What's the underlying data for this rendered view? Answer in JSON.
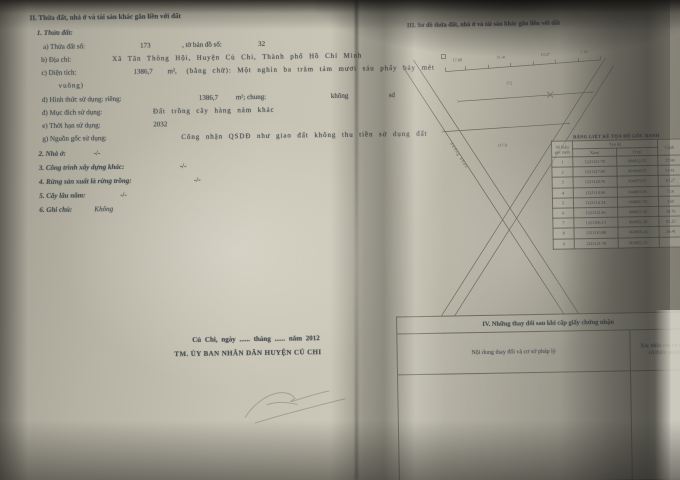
{
  "section_ii": {
    "heading": "II. Thửa đất, nhà ở và tài sản khác gắn liền với đất",
    "parcel": {
      "title": "1. Thửa đất:",
      "a_label": "a) Thửa đất số:",
      "a_value": "173",
      "a_label2": ", tờ bản đồ số:",
      "a_value2": "32",
      "b_label": "b) Địa chỉ:",
      "b_value": "Xã Tân Thông Hội, Huyện Củ Chi, Thành phố Hồ Chí Minh",
      "c_label": "c) Diện tích:",
      "c_value": "1386,7",
      "c_unit": "m²,",
      "c_words": "(bằng chữ): Một nghìn ba trăm tám mươi sáu phẩy bảy mét",
      "c_words_cont": "vuông)",
      "d_label": "d) Hình thức sử dụng: riêng:",
      "d_value": "1386,7",
      "d_mid": "m²; chung:",
      "d_value2": "không",
      "d_suffix": "sd",
      "dd_label": "đ) Mục đích sử dụng:",
      "dd_value": "Đất trồng cây hàng năm khác",
      "e_label": "e) Thời hạn sử dụng:",
      "e_value": "2032",
      "g_label": "g) Nguồn gốc sử dụng:",
      "g_value": "Công nhận QSDĐ như giao đất không thu tiền sử dụng đất"
    },
    "item2_label": "2. Nhà ở:",
    "item2_value": "-/-",
    "item3_label": "3. Công trình xây dựng khác:",
    "item3_value": "-/-",
    "item4_label": "4. Rừng sản xuất là rừng trồng:",
    "item4_value": "-/-",
    "item5_label": "5. Cây lâu năm:",
    "item5_value": "-/-",
    "item6_label": "6. Ghi chú:",
    "item6_value": "Không"
  },
  "signature": {
    "place_date": "Củ Chi, ngày ...... tháng ...... năm 2012",
    "authority": "TM. ỦY BAN NHÂN DÂN HUYỆN CỦ CHI"
  },
  "section_iii": {
    "heading": "III. Sơ đồ thửa đất, nhà ở và tài sản khác gắn liền với đất",
    "diagram": {
      "road_label": "đường nhựa",
      "neighbor_label": "172",
      "parcel_label": "(173)",
      "ticks": [
        "17.88",
        "31.41",
        "10.27",
        "7.16"
      ]
    }
  },
  "coord_table": {
    "title": "BẢNG LIỆT KÊ TỌA ĐỘ GÓC RANH",
    "col_corner": "Số hiệu góc ranh",
    "col_coord": "Tọa độ",
    "col_x": "X(m)",
    "col_y": "Y(m)",
    "col_edge": "Cạnh",
    "rows": [
      [
        "1",
        "1221121.78",
        "604952.55",
        "17.88"
      ],
      [
        "2",
        "1221127.80",
        "604968.55",
        "31.41"
      ],
      [
        "3",
        "1221128.76",
        "604875.67",
        "10.27"
      ],
      [
        "4",
        "1221114.84",
        "604883.85",
        "7.16"
      ],
      [
        "5",
        "1221114.34",
        "604896.78",
        "3.60"
      ],
      [
        "6",
        "1221112.96",
        "604857.43",
        "18.76"
      ],
      [
        "7",
        "1221106.13",
        "604852.28",
        "81.25"
      ],
      [
        "8",
        "1221110.88",
        "604850.24",
        "26.41"
      ],
      [
        "9",
        "1221121.78",
        "604952.55",
        ""
      ]
    ]
  },
  "section_iv": {
    "heading": "IV. Những thay đổi sau khi cấp giấy chứng nhận",
    "col_content": "Nội dung thay đổi và cơ sở pháp lý",
    "col_confirm_1": "Xác nhận của cơ quan",
    "col_confirm_2": "có thẩm quyền"
  }
}
